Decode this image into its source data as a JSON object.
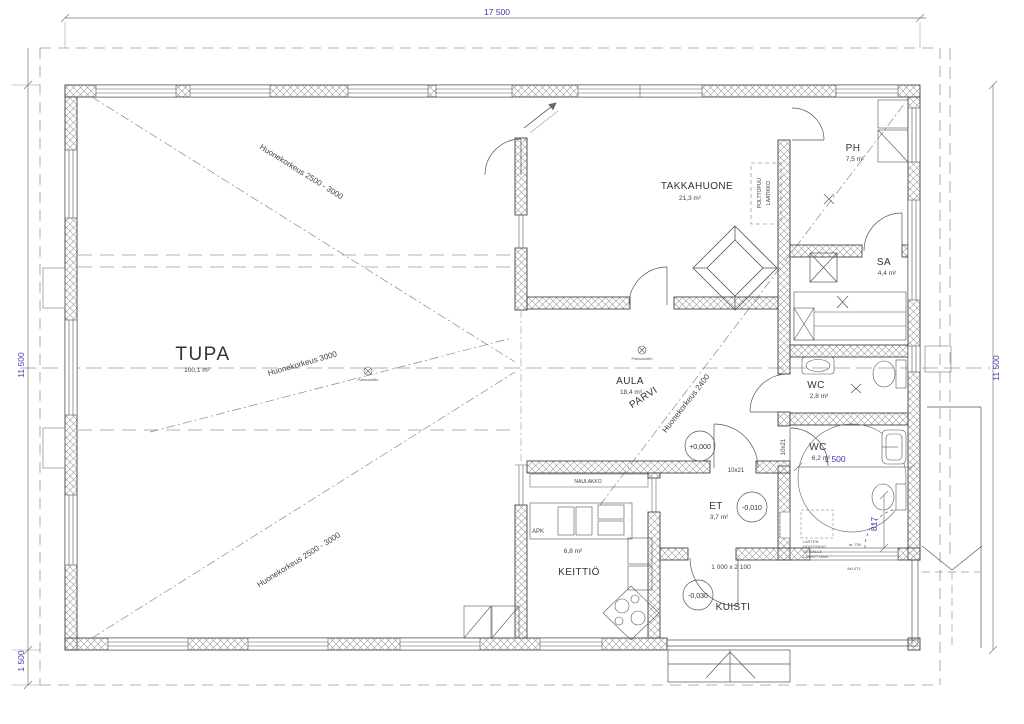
{
  "dimensions": {
    "top": "17 500",
    "left": "11 500",
    "right": "11 500",
    "bottom_left": "1 500",
    "wc_turning": "1 500",
    "door_817": "817"
  },
  "rooms": {
    "tupa": {
      "name": "TUPA",
      "area": "100,1 m²"
    },
    "takkahuone": {
      "name": "TAKKAHUONE",
      "area": "21,3 m²"
    },
    "ph": {
      "name": "PH",
      "area": "7,5 m²"
    },
    "sa": {
      "name": "SA",
      "area": "4,4 m²"
    },
    "wc_small": {
      "name": "WC",
      "area": "2,8 m²"
    },
    "wc_large": {
      "name": "WC",
      "area": "6,2 m²"
    },
    "aula": {
      "name": "AULA",
      "area": "18,4 m²"
    },
    "parvi": {
      "name": "PARVI"
    },
    "et": {
      "name": "ET",
      "area": "3,7 m²"
    },
    "keittio": {
      "name": "KEITTIÖ",
      "area": "6,8 m²"
    },
    "kuisti": {
      "name": "KUISTI"
    }
  },
  "levels": {
    "aula": "+0,000",
    "et": "-0,010",
    "kuisti": "-0,030"
  },
  "notes": {
    "height_upper": "Huonekorkeus 2500 - 3000",
    "height_mid": "Huonekorkeus 3000",
    "height_lower": "Huonekorkeus 2500 - 3000",
    "height_aula": "Huonekorkeus 2400",
    "smoke_detector": "Palovaroitin",
    "firewood_line1": "POLTTOPUU",
    "firewood_line2": "LAATIKKO",
    "coat_rack": "NAULAKKO",
    "dishwasher": "APK",
    "changing_table": [
      "LASTEN",
      "HOITOTASO",
      "SEINÄLLE",
      "LASKETTAVA"
    ],
    "ar750": "ar. 750",
    "window_code": "8x14T1"
  },
  "doors": {
    "interior": "10x21",
    "kuisti": "1 000 x 2 100"
  },
  "colors": {
    "dim_text": "#3c3cae",
    "wall_line": "#444444",
    "hatch": "#9a9a9a"
  }
}
